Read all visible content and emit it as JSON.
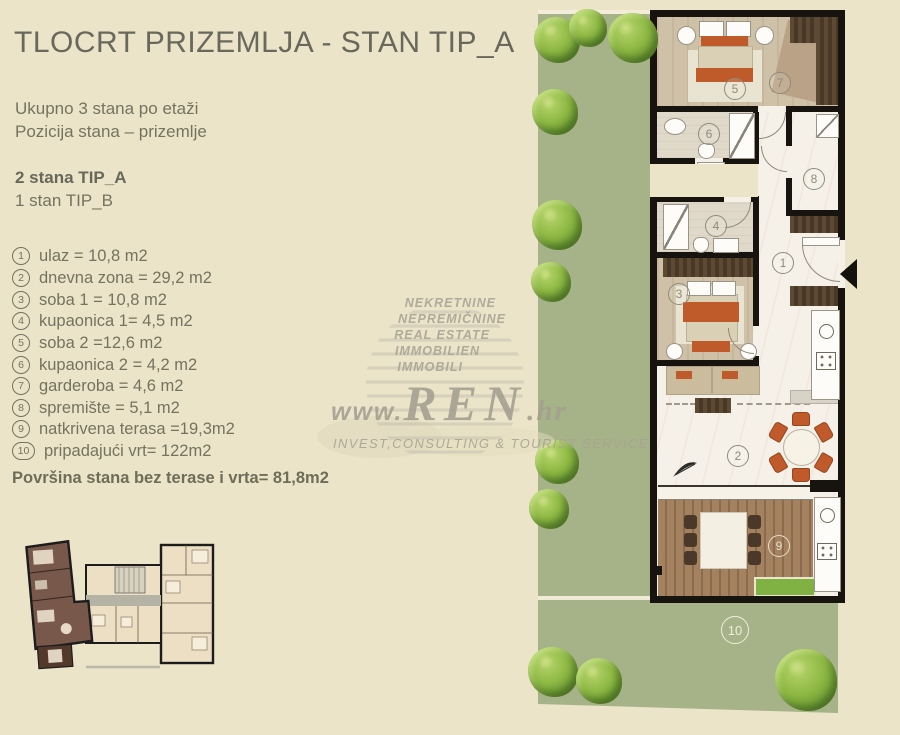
{
  "title": "TLOCRT PRIZEMLJA - STAN TIP_A",
  "intro": {
    "line1": "Ukupno 3 stana po etaži",
    "line2": "Pozicija stana – prizemlje",
    "emphasis": "2 stana TIP_A",
    "line3": "1 stan TIP_B"
  },
  "legend": {
    "items": [
      {
        "num": "1",
        "text": "ulaz = 10,8 m2"
      },
      {
        "num": "2",
        "text": "dnevna zona = 29,2 m2"
      },
      {
        "num": "3",
        "text": "soba 1 = 10,8 m2"
      },
      {
        "num": "4",
        "text": "kupaonica  1= 4,5 m2"
      },
      {
        "num": "5",
        "text": "soba 2 =12,6 m2"
      },
      {
        "num": "6",
        "text": "kupaonica 2 = 4,2 m2"
      },
      {
        "num": "7",
        "text": "garderoba = 4,6 m2"
      },
      {
        "num": "8",
        "text": "spremište = 5,1 m2"
      },
      {
        "num": "9",
        "text": "natkrivena terasa =19,3m2"
      },
      {
        "num": "10",
        "text": "pripadajući vrt= 122m2"
      }
    ],
    "summary": "Površina stana bez terase i vrta= 81,8m2"
  },
  "watermark": {
    "lines": [
      "NEKRETNINE",
      "NEPREMIČNINE",
      "REAL ESTATE",
      "IMMOBILIEN",
      "IMMOBILI"
    ],
    "www": "www.",
    "brand": "REN",
    "tld": ".hr",
    "tagline": "INVEST,CONSULTING & TOURIST SERVICE"
  },
  "plan": {
    "labels": [
      "1",
      "2",
      "3",
      "4",
      "5",
      "6",
      "7",
      "8",
      "9",
      "10"
    ]
  },
  "colors": {
    "background": "#ece4c9",
    "garden": "#a6b287",
    "wall": "#17140f",
    "accent_orange": "#bf5b2a",
    "deck_wood": "#a07d5d",
    "dark_wood": "#5d4a35",
    "mini_plan_highlight": "#77584a",
    "text": "#6e6e5e"
  }
}
